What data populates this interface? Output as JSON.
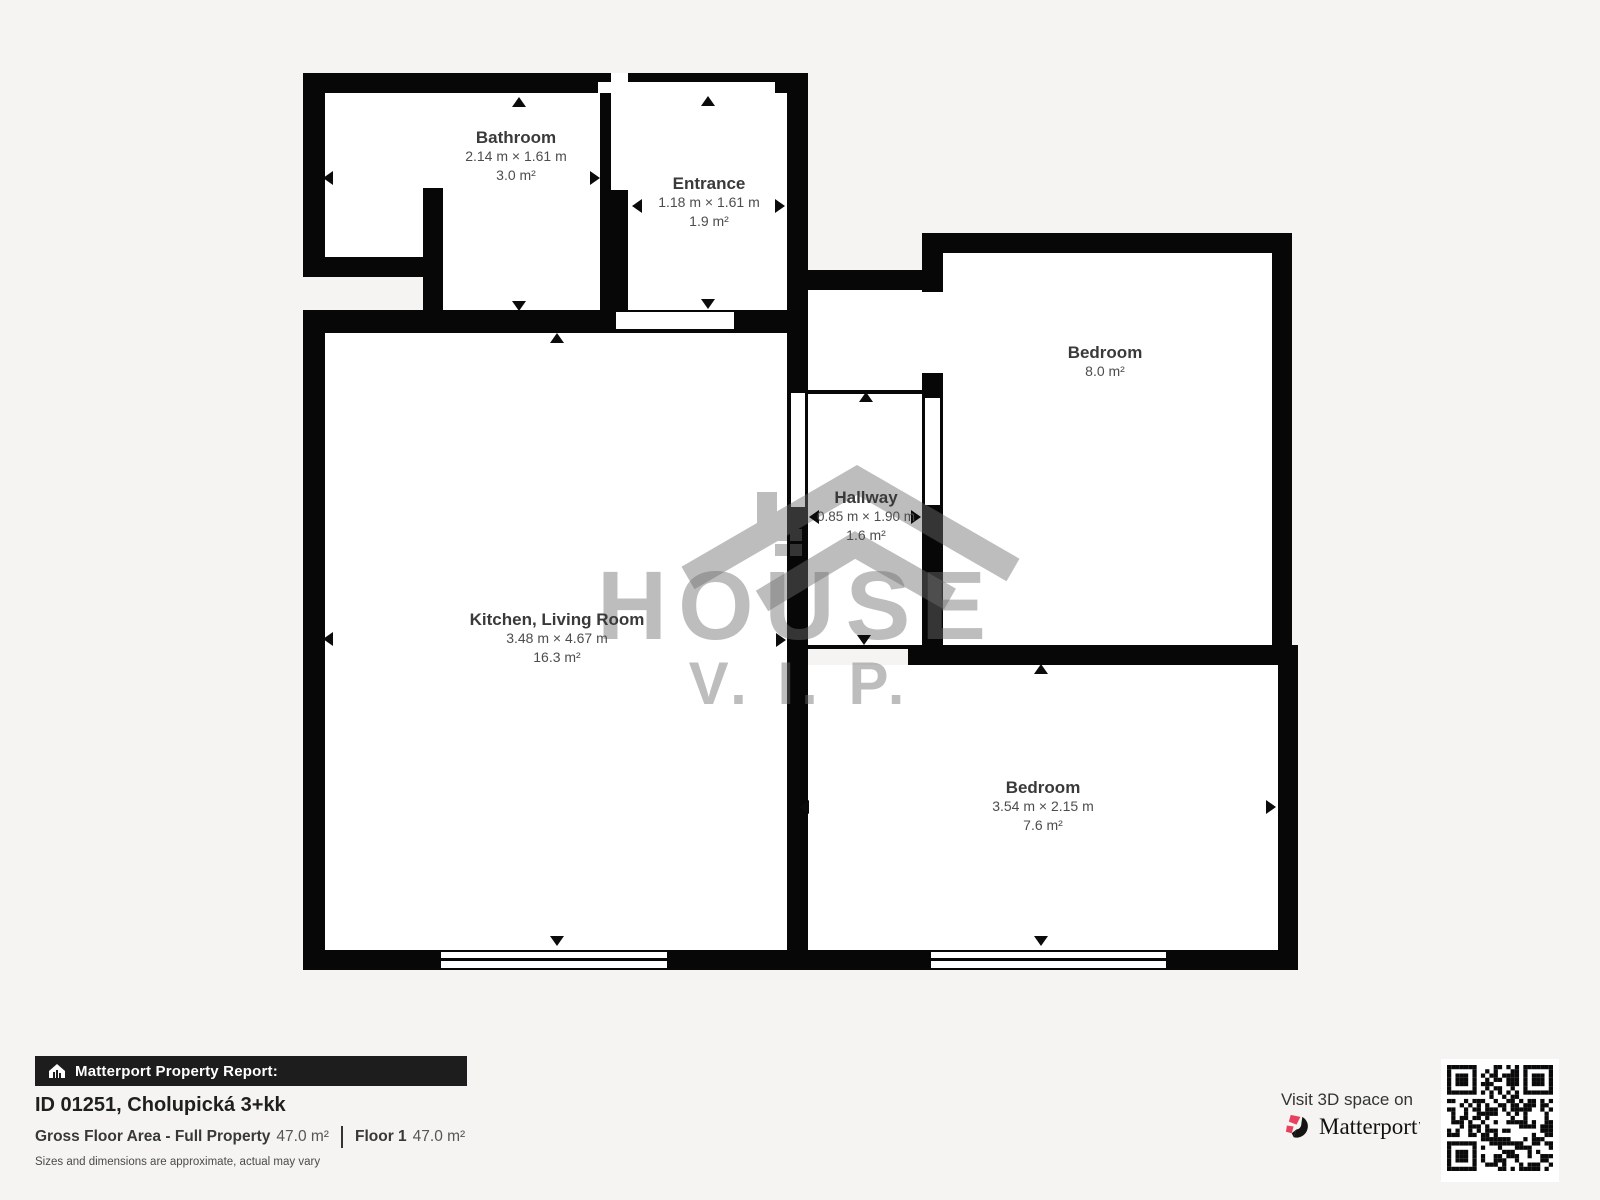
{
  "page": {
    "background": "#f5f4f2"
  },
  "floorplan": {
    "rooms": [
      {
        "name": "Bathroom",
        "dims": "2.14 m × 1.61 m",
        "area": "3.0 m²"
      },
      {
        "name": "Entrance",
        "dims": "1.18 m × 1.61 m",
        "area": "1.9 m²"
      },
      {
        "name": "Bedroom",
        "dims": "",
        "area": "8.0 m²"
      },
      {
        "name": "Hallway",
        "dims": "0.85 m × 1.90 m",
        "area": "1.6 m²"
      },
      {
        "name": "Kitchen, Living Room",
        "dims": "3.48 m × 4.67 m",
        "area": "16.3 m²"
      },
      {
        "name": "Bedroom",
        "dims": "3.54 m × 2.15 m",
        "area": "7.6 m²"
      }
    ],
    "watermark": {
      "title": "HOUSE",
      "subtitle": "V. I. P."
    }
  },
  "footer": {
    "report_bar": "Matterport Property Report:",
    "property_title": "ID 01251, Cholupická 3+kk",
    "gfa_label": "Gross Floor Area - Full Property",
    "gfa_value": "47.0 m²",
    "floor_label": "Floor 1",
    "floor_value": "47.0 m²",
    "disclaimer": "Sizes and dimensions are approximate, actual may vary",
    "visit_text": "Visit 3D space on",
    "brand_name": "Matterport",
    "brand_mark": "’"
  },
  "colors": {
    "wall": "#070707",
    "background": "#f5f4f2",
    "interior": "#ffffff",
    "accent_red": "#e8415f",
    "watermark_gray": "#6e6e6e"
  }
}
